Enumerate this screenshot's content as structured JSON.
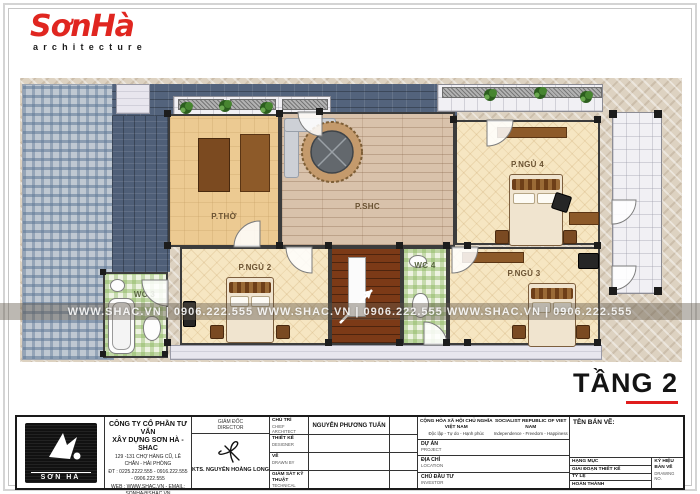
{
  "header": {
    "brand": "SơnHà",
    "tagline": "architecture"
  },
  "plan": {
    "floor_label": "TẦNG 2",
    "watermark": "WWW.SHAC.VN   |   0906.222.555        WWW.SHAC.VN   |   0906.222.555        WWW.SHAC.VN   |   0906.222.555",
    "rooms": {
      "worship": "P.THỜ",
      "living": "P.SHC",
      "bedroom2": "P.NGỦ 2",
      "bedroom3": "P.NGỦ 3",
      "bedroom4": "P.NGỦ 4",
      "wc3": "WC 3",
      "wc4": "WC 4"
    }
  },
  "title_block": {
    "company": {
      "logo_text": "SƠN HÀ",
      "name_line1": "CÔNG TY CỔ PHẦN TƯ VẤN",
      "name_line2": "XÂY DỰNG SƠN HÀ - SHAC",
      "address": "129 -131 CHỢ HÀNG CŨ, LÊ CHÂN - HẢI PHÒNG",
      "phone": "ĐT : 0225.2222.555 - 0916.222.555 - 0906.222.555",
      "web": "WEB : WWW.SHAC.VN - EMAIL: SONHA@SHAC.VN"
    },
    "director": {
      "label_vi": "GIÁM ĐỐC",
      "label_en": "DIRECTOR",
      "name": "KTS. NGUYỄN HOÀNG LONG"
    },
    "roles": [
      {
        "vi": "CHỦ TRÌ",
        "en": "CHIEF ARCHITECT",
        "value": "NGUYỄN PHƯƠNG TUẤN"
      },
      {
        "vi": "THIẾT KẾ",
        "en": "DESIGNER",
        "value": ""
      },
      {
        "vi": "VẼ",
        "en": "DRAWN BY",
        "value": ""
      },
      {
        "vi": "GIÁM SÁT KỸ THUẬT",
        "en": "TECHNICAL SUPERVISOR",
        "value": ""
      }
    ],
    "republic": {
      "vi_line1": "CỘNG HÒA XÃ HỘI CHỦ NGHĨA VIỆT NAM",
      "vi_line2": "Độc lập - Tự do - Hạnh phúc",
      "en_line1": "SOCIALIST REPUBLIC OF VIET NAM",
      "en_line2": "Independence - Freedom - Happiness"
    },
    "project_rows": [
      {
        "vi": "DỰ ÁN",
        "en": "PROJECT"
      },
      {
        "vi": "ĐỊA CHỈ",
        "en": "LOCATION"
      },
      {
        "vi": "CHỦ ĐẦU TƯ",
        "en": "INVESTOR"
      }
    ],
    "drawing": {
      "title_label": "TÊN BẢN VẼ:",
      "rows": [
        {
          "vi": "HẠNG MỤC",
          "en": "CATEGORY"
        },
        {
          "vi": "GIAI ĐOẠN THIẾT KẾ",
          "en": "DESIGN STAGE"
        },
        {
          "vi": "TỶ LỆ",
          "en": "SCALE"
        },
        {
          "vi": "HOÀN THÀNH",
          "en": "FINISH"
        }
      ],
      "code_label_vi": "KÝ HIỆU BẢN VẼ",
      "code_label_en": "DRAWING NO."
    }
  }
}
